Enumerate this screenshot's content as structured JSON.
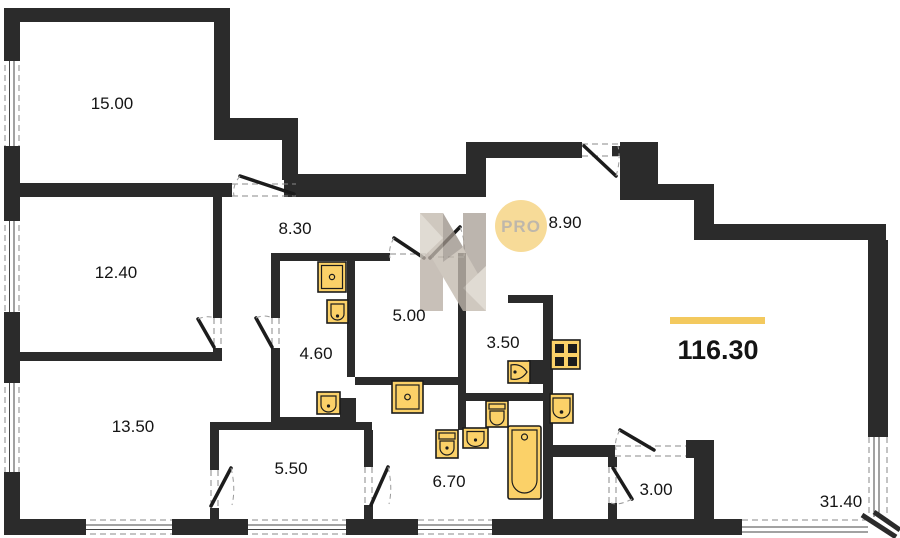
{
  "plan": {
    "total_area": "116.30",
    "rooms": [
      {
        "label": "15.00"
      },
      {
        "label": "12.40"
      },
      {
        "label": "8.30"
      },
      {
        "label": "8.90"
      },
      {
        "label": "5.00"
      },
      {
        "label": "4.60"
      },
      {
        "label": "3.50"
      },
      {
        "label": "13.50"
      },
      {
        "label": "5.50"
      },
      {
        "label": "6.70"
      },
      {
        "label": "3.00"
      },
      {
        "label": "31.40"
      }
    ]
  },
  "watermark": {
    "badge": "PRO",
    "letter_icon": "n-logo-icon",
    "badge_color": "#f5d17c"
  },
  "fixtures": [
    "washing-machine-icon",
    "sink-icon",
    "toilet-icon",
    "washing-machine-icon",
    "toilet-icon",
    "sink-icon",
    "bathtub-icon",
    "sink-icon",
    "toilet-icon",
    "stove-icon",
    "kitchen-sink-icon"
  ],
  "colors": {
    "wall": "#2b2b2b",
    "fixture": "#fbd168",
    "accent_bar": "#f3c95e",
    "watermark_gray": "#b6aca2"
  }
}
